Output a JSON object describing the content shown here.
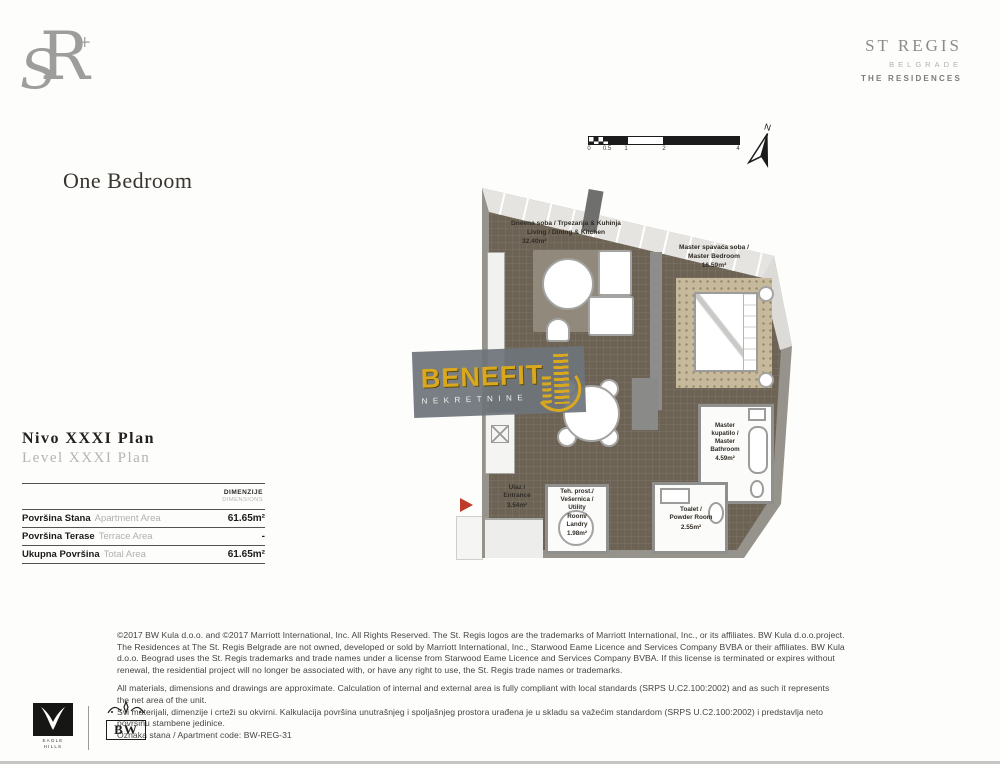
{
  "brand": {
    "monogram_s": "S",
    "monogram_r": "R",
    "monogram_accent": "+",
    "logo_line1": "ST REGIS",
    "logo_line2": "BELGRADE",
    "logo_line3": "THE RESIDENCES"
  },
  "page": {
    "title": "One Bedroom"
  },
  "compass": {
    "north": "N"
  },
  "scalebar": {
    "ticks": [
      "0",
      "0.5",
      "1",
      "2",
      "4"
    ]
  },
  "plan": {
    "rooms": {
      "living": {
        "label": "Dnevna soba / Trpezarija & Kuhinja\nLiving / Dining & Kitchen",
        "area": "32.40m²"
      },
      "bedroom": {
        "label": "Master spavaća soba /\nMaster Bedroom",
        "area": "16.59m²"
      },
      "bathroom": {
        "label": "Master\nkupatilo /\nMaster\nBathroom",
        "area": "4.59m²"
      },
      "entrance": {
        "label": "Ulaz /\nEntrance",
        "area": "3.54m²"
      },
      "utility": {
        "label": "Teh. prost./\nVešernica /\nUtility\nRoom/\nLandry",
        "area": "1.98m²"
      },
      "toilet": {
        "label": "Toalet /\nPowder Room",
        "area": "2.55m²"
      }
    }
  },
  "watermark": {
    "title": "BENEFIT",
    "subtitle": "NEKRETNINE"
  },
  "level": {
    "sr": "Nivo XXXI Plan",
    "en": "Level XXXI Plan"
  },
  "table": {
    "header": {
      "sr": "DIMENZIJE",
      "en": "DIMENSIONS"
    },
    "rows": [
      {
        "label_sr": "Površina Stana",
        "label_en": "Apartment Area",
        "value": "61.65m²"
      },
      {
        "label_sr": "Površina Terase",
        "label_en": "Terrace Area",
        "value": "-"
      },
      {
        "label_sr": "Ukupna Površina",
        "label_en": "Total Area",
        "value": "61.65m²"
      }
    ]
  },
  "footer": {
    "lines": [
      "©2017 BW Kula d.o.o. and ©2017 Marriott International, Inc. All Rights Reserved. The St. Regis logos are the trademarks of Marriott International, Inc., or its affiliates. BW Kula d.o.o.project.",
      "The Residences at The St. Regis Belgrade are not owned, developed or sold by Marriott International, Inc., Starwood Eame Licence and Services Company BVBA or their affiliates. BW Kula",
      "d.o.o. Beograd uses the St. Regis trademarks and trade names under a license from Starwood Eame Licence and Services Company BVBA. If this license is terminated or expires without",
      "renewal, the residential project will no longer be associated with, or have any right to use, the St. Regis trade names or trademarks.",
      "All materials, dimensions and drawings are approximate. Calculation of internal and external area is fully compliant with local standards (SRPS U.C2.100:2002) and as such it represents",
      "the net area of the unit.",
      "Svi materijali, dimenzije i crteži su okvirni. Kalkulacija površina unutrašnjeg i spoljašnjeg prostora urađena je u skladu sa važećim standardom (SRPS U.C2.100:2002) i predstavlja neto",
      "površinu stambene jedinice.",
      "Oznaka stana / Apartment code: BW-REG-31"
    ],
    "logos": {
      "eagle_top": "EAGLE",
      "eagle_bottom": "HILLS",
      "bw": "BW"
    }
  },
  "colors": {
    "accent_gold": "#d9a81f",
    "floor_brown": "#6d6355",
    "wall_gray": "#95938b",
    "watermark_gray": "#6e747a",
    "entrance_arrow_red": "#bf3a2b"
  }
}
